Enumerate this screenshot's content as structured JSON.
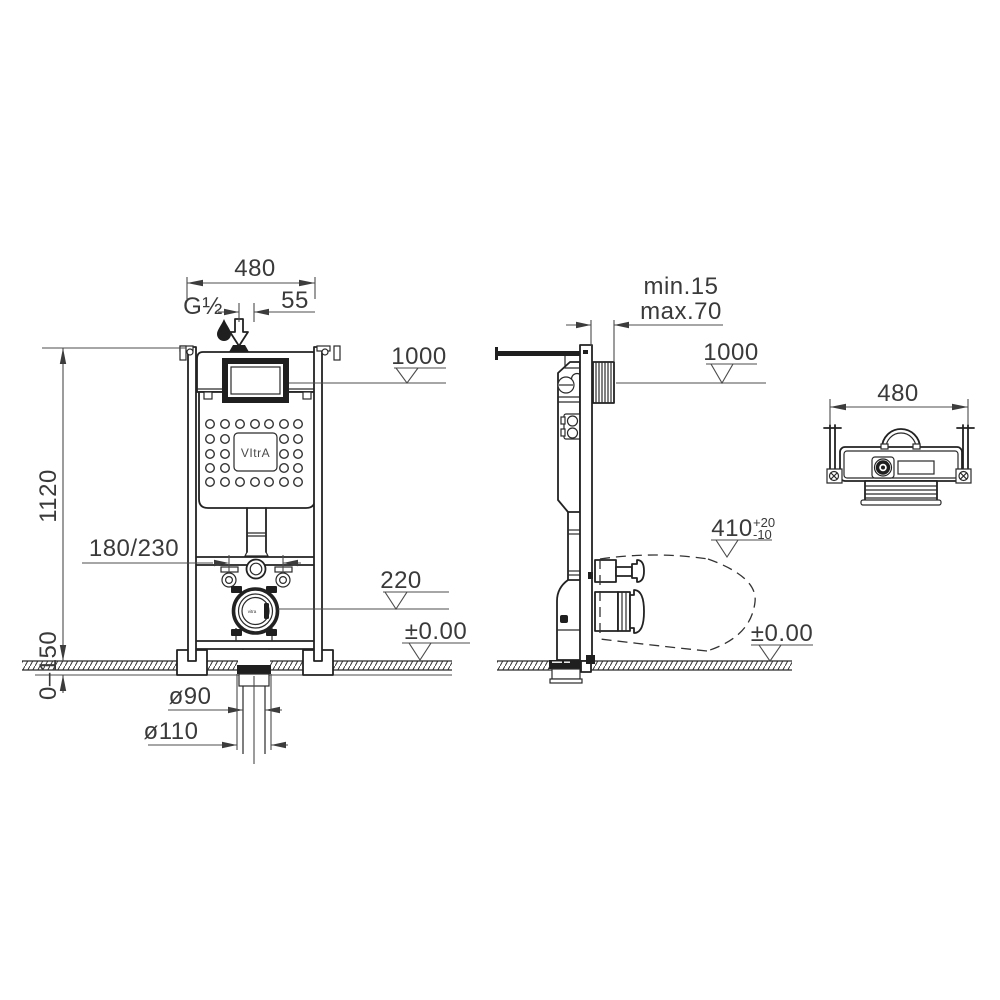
{
  "front_view": {
    "width": "480",
    "water_inlet": "G½",
    "inlet_offset": "55",
    "lid_height_datum": "1000",
    "frame_height": "1120",
    "fixing_spacing": "180/230",
    "outlet_datum": "220",
    "floor_datum": "±0.00",
    "floor_adjust_range": "0–150",
    "drain_inner_dia": "ø90",
    "drain_outer_dia": "ø110",
    "brand": "VItrA",
    "drain_label": "vitra"
  },
  "side_view": {
    "wall_min": "min.15",
    "wall_max": "max.70",
    "lid_height_datum": "1000",
    "pan_length": "410",
    "pan_tol_plus": "+20",
    "pan_tol_minus": "-10",
    "floor_datum": "±0.00"
  },
  "top_view": {
    "width": "480"
  }
}
